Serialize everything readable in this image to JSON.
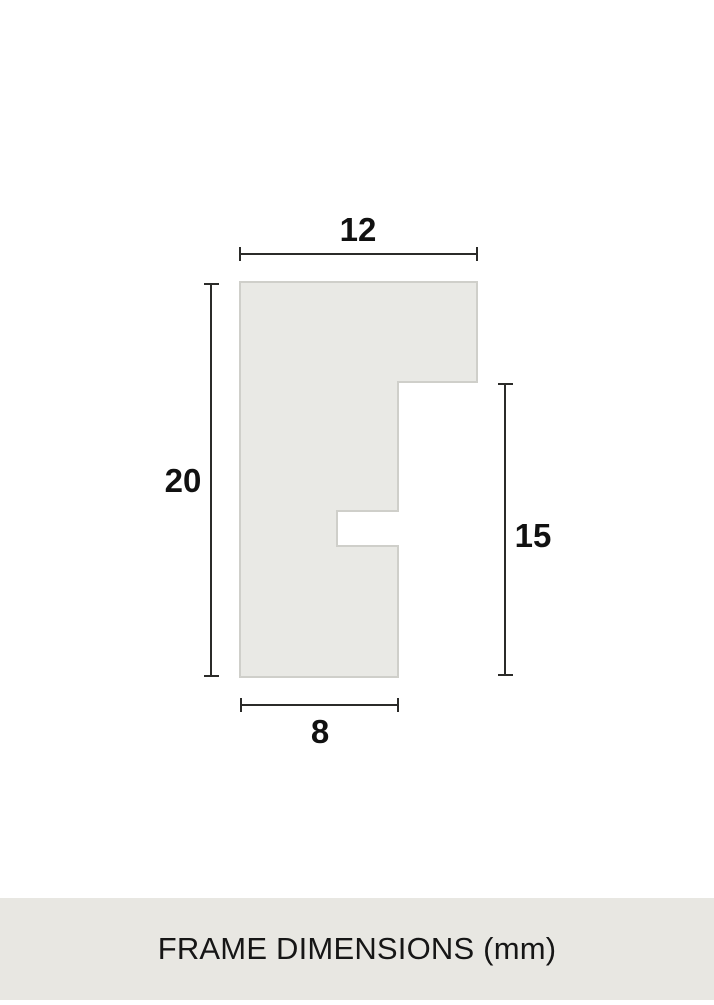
{
  "diagram": {
    "title": "frame-profile-cross-section",
    "dimensions": {
      "top_width": "12",
      "left_height": "20",
      "right_height": "15",
      "bottom_width": "8"
    },
    "unit": "mm"
  },
  "footer": {
    "label": "FRAME DIMENSIONS (mm)"
  },
  "colors": {
    "background": "#ffffff",
    "shape_fill": "#e9e9e5",
    "shape_border": "#cfcfca",
    "dimension_line": "#2b2b29",
    "label_text": "#111111",
    "footer_bg": "#e8e7e2",
    "footer_text": "#161616"
  }
}
